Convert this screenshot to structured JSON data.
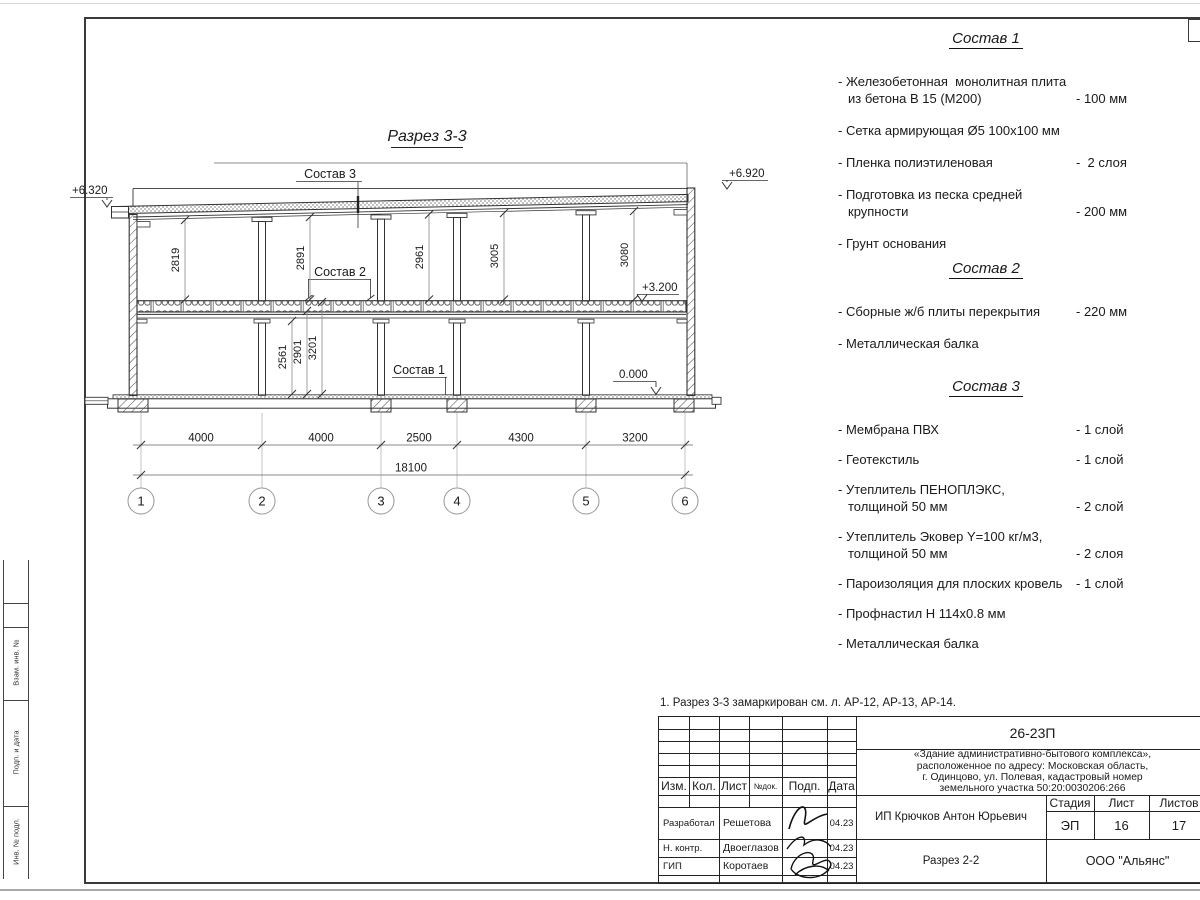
{
  "drawing": {
    "title": "Разрез 3-3",
    "labels": {
      "sostav1": "Состав 1",
      "sostav2": "Состав 2",
      "sostav3": "Состав 3"
    },
    "elevations": {
      "left": "+6.320",
      "right": "+6.920",
      "floor2": "+3.200",
      "ground": "0.000"
    },
    "dims_upper": [
      "2819",
      "2891",
      "2961",
      "3005",
      "3080"
    ],
    "dims_lower": [
      "2561",
      "2901",
      "3201"
    ],
    "dims_horizontal": [
      "4000",
      "4000",
      "2500",
      "4300",
      "3200"
    ],
    "dim_total": "18100",
    "axes": [
      "1",
      "2",
      "3",
      "4",
      "5",
      "6"
    ]
  },
  "specs": [
    {
      "title": "Состав 1",
      "items": [
        {
          "name": "- Железобетонная  монолитная плита\nиз бетона В 15 (М200)",
          "value": "- 100 мм"
        },
        {
          "name": "- Сетка армирующая Ø5 100х100 мм",
          "value": ""
        },
        {
          "name": "- Пленка полиэтиленовая",
          "value": "-  2 слоя"
        },
        {
          "name": "- Подготовка из песка средней\nкрупности",
          "value": "- 200 мм"
        },
        {
          "name": "- Грунт основания",
          "value": ""
        }
      ]
    },
    {
      "title": "Состав 2",
      "items": [
        {
          "name": "- Сборные ж/б плиты перекрытия",
          "value": "- 220 мм"
        },
        {
          "name": "- Металлическая балка",
          "value": ""
        }
      ]
    },
    {
      "title": "Состав 3",
      "items": [
        {
          "name": "- Мембрана ПВХ",
          "value": "- 1 слой"
        },
        {
          "name": "- Геотекстиль",
          "value": "- 1 слой"
        },
        {
          "name": "- Утеплитель ПЕНОПЛЭКС,\nтолщиной 50 мм",
          "value": "- 2 слой"
        },
        {
          "name": "- Утеплитель Эковер Y=100 кг/м3,\nтолщиной 50 мм",
          "value": "- 2 слоя"
        },
        {
          "name": "- Пароизоляция для плоских кровель",
          "value": "- 1 слой"
        },
        {
          "name": "- Профнастил Н 114х0.8 мм",
          "value": ""
        },
        {
          "name": "- Металлическая балка",
          "value": ""
        }
      ]
    }
  ],
  "note": {
    "text": "1. Разрез 3-3 замаркирован см. л. АР-12, АР-13, АР-14."
  },
  "margin_labels": {
    "seg1": "Взам. инв. №",
    "seg2": "Подп. и дата",
    "seg3": "Инв. № подл."
  },
  "titleblock": {
    "doc_number": "26-23П",
    "project": "«Здание административно-бытового комплекса»,\nрасположенное по адресу: Московская область,\nг. Одинцово, ул. Полевая, кадастровый номер\nземельного участка 50:20:0030206:266",
    "header": {
      "izm": "Изм.",
      "kol": "Кол.",
      "list": "Лист",
      "ndok": "№док.",
      "podp": "Подп.",
      "data": "Дата"
    },
    "rows": [
      {
        "role": "Разработал",
        "name": "Решетова",
        "date": "04.23"
      },
      {
        "role": "Н. контр.",
        "name": "Двоеглазов",
        "date": "04.23"
      },
      {
        "role": "ГИП",
        "name": "Коротаев",
        "date": "04.23"
      }
    ],
    "stage_label": "Стадия",
    "sheet_label": "Лист",
    "sheets_label": "Листов",
    "stage": "ЭП",
    "sheet_no": "16",
    "sheets_total": "17",
    "client": "ИП Крючков Антон Юрьевич",
    "drawing_name": "Разрез 2-2",
    "company": "ООО \"Альянс\""
  },
  "colors": {
    "line": "#333333",
    "dim": "#888888",
    "text": "#1a1a1a"
  }
}
